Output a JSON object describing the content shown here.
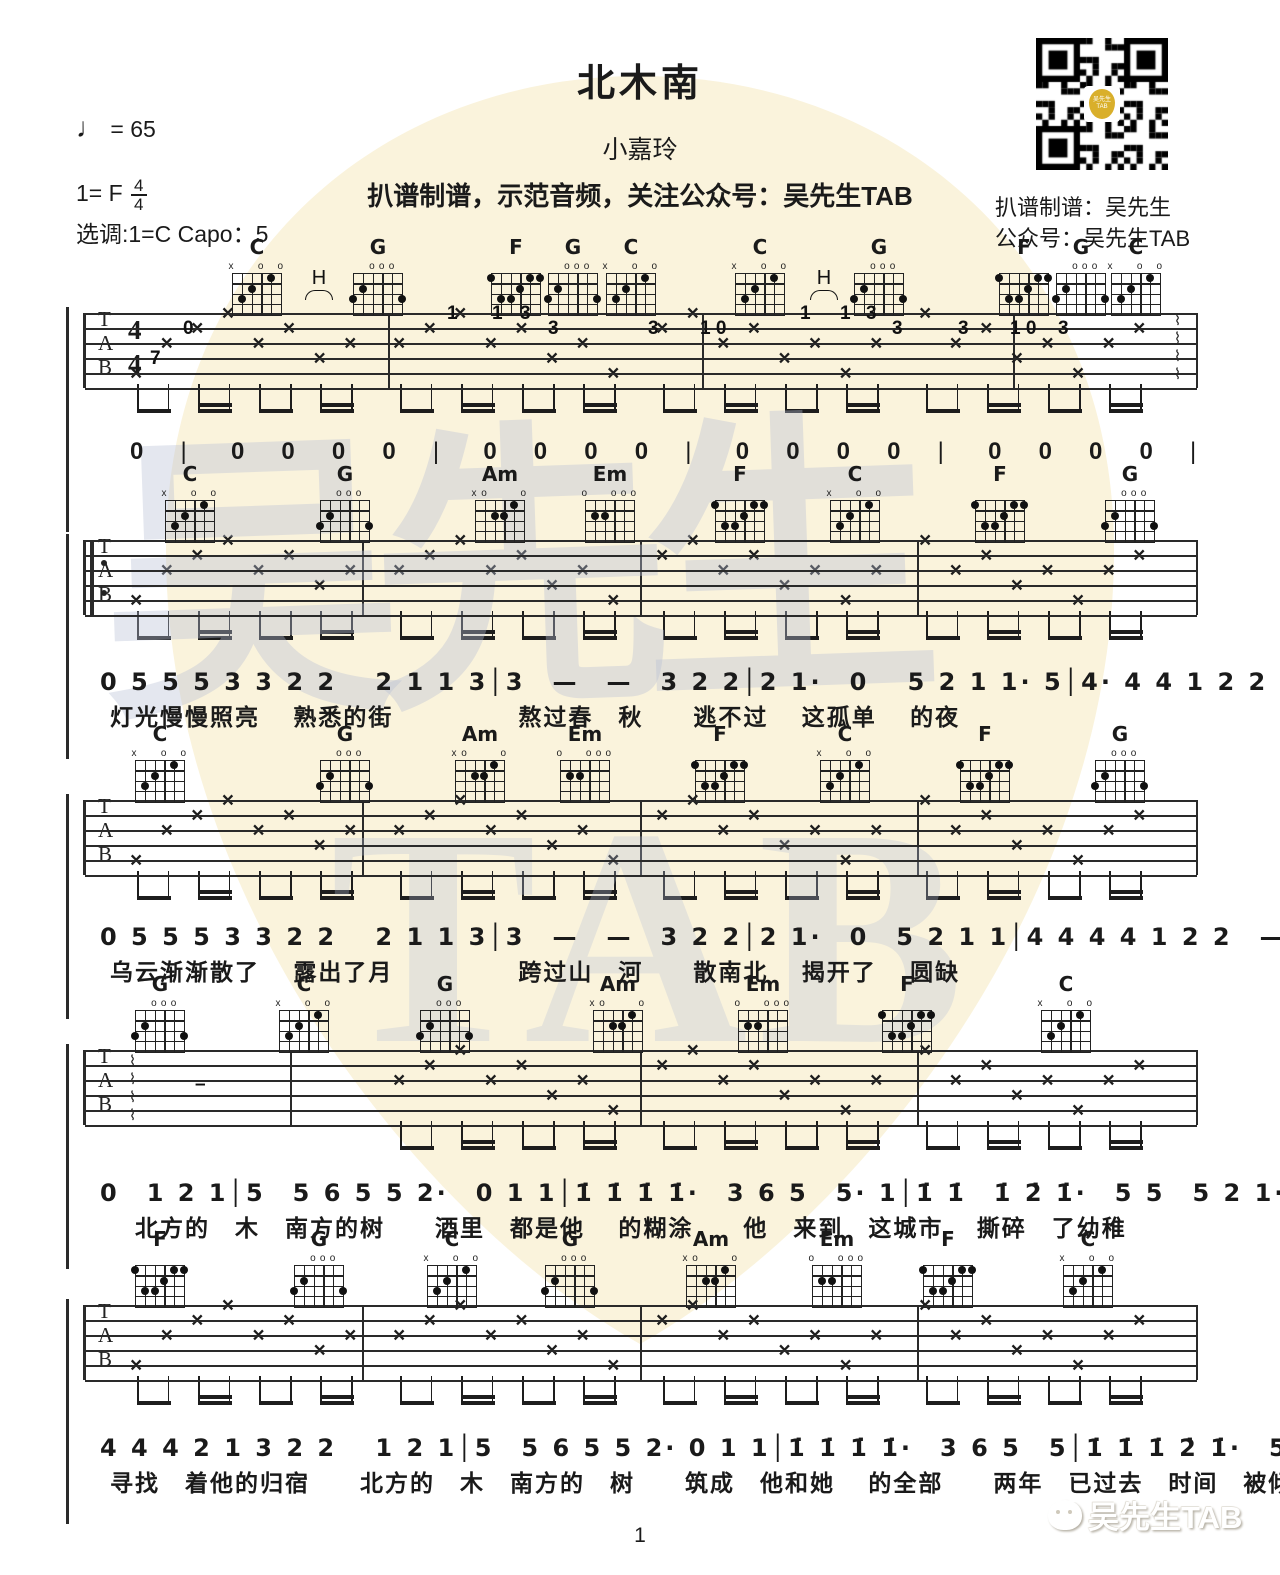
{
  "header": {
    "title": "北木南",
    "artist": "小嘉玲",
    "promo": "扒谱制谱，示范音频，关注公众号：吴先生TAB",
    "tempo_note": "♩",
    "tempo_value": "=  65",
    "key_label": "1= F",
    "time_top": "4",
    "time_bottom": "4",
    "tuning_label": "选调:1=C   Capo：5"
  },
  "qr": {
    "caption_line1": "扒谱制谱：吴先生",
    "caption_line2": "公众号：吴先生TAB",
    "logo_text": "吴先生TAB"
  },
  "watermark": {
    "hanzi": "吴先生",
    "latin": "TAB",
    "pick_color": "#faf3dc",
    "text_color": "#b7c0d6"
  },
  "footer": {
    "page_number": "1",
    "logo_text": "吴先生TAB"
  },
  "chord_shapes": {
    "C": {
      "mute": [
        6
      ],
      "open": [
        3,
        1
      ],
      "dots": [
        [
          5,
          3
        ],
        [
          4,
          2
        ],
        [
          2,
          1
        ]
      ]
    },
    "G": {
      "mute": [],
      "open": [
        4,
        3,
        2
      ],
      "dots": [
        [
          6,
          3
        ],
        [
          5,
          2
        ],
        [
          1,
          3
        ]
      ]
    },
    "F": {
      "mute": [],
      "open": [],
      "dots": [
        [
          6,
          1
        ],
        [
          5,
          3
        ],
        [
          4,
          3
        ],
        [
          3,
          2
        ],
        [
          2,
          1
        ],
        [
          1,
          1
        ]
      ]
    },
    "Am": {
      "mute": [
        6
      ],
      "open": [
        5,
        1
      ],
      "dots": [
        [
          4,
          2
        ],
        [
          3,
          2
        ],
        [
          2,
          1
        ]
      ]
    },
    "Em": {
      "mute": [],
      "open": [
        6,
        3,
        2,
        1
      ],
      "dots": [
        [
          5,
          2
        ],
        [
          4,
          2
        ]
      ]
    }
  },
  "systems": [
    {
      "staff_y": 313,
      "has_time_sig": true,
      "repeat_start": false,
      "end_arrow": true,
      "chords": [
        {
          "name": "C",
          "x": 257
        },
        {
          "name": "G",
          "x": 378
        },
        {
          "name": "F",
          "x": 516
        },
        {
          "name": "G",
          "x": 573
        },
        {
          "name": "C",
          "x": 631
        },
        {
          "name": "C",
          "x": 760
        },
        {
          "name": "G",
          "x": 879
        },
        {
          "name": "F",
          "x": 1024
        },
        {
          "name": "G",
          "x": 1081
        },
        {
          "name": "C",
          "x": 1136
        }
      ],
      "hammer_label": "H",
      "hammers": [
        318,
        823
      ],
      "fret_marks": [
        {
          "t": "0",
          "x": 183,
          "row": 1
        },
        {
          "t": "7",
          "x": 150,
          "row": 3
        },
        {
          "t": "1",
          "x": 447,
          "row": 0
        },
        {
          "t": "1",
          "x": 492,
          "row": 0
        },
        {
          "t": "3",
          "x": 520,
          "row": 0
        },
        {
          "t": "3",
          "x": 548,
          "row": 1
        },
        {
          "t": "3",
          "x": 648,
          "row": 1
        },
        {
          "t": "1 0",
          "x": 700,
          "row": 1
        },
        {
          "t": "1",
          "x": 800,
          "row": 0
        },
        {
          "t": "1",
          "x": 840,
          "row": 0
        },
        {
          "t": "3",
          "x": 866,
          "row": 0
        },
        {
          "t": "3",
          "x": 892,
          "row": 1
        },
        {
          "t": "3",
          "x": 958,
          "row": 1
        },
        {
          "t": "1 0",
          "x": 1010,
          "row": 1
        },
        {
          "t": "3",
          "x": 1058,
          "row": 1
        }
      ],
      "barlines": [
        388,
        702,
        1013
      ]
    },
    {
      "staff_y": 540,
      "has_time_sig": false,
      "repeat_start": true,
      "chords": [
        {
          "name": "C",
          "x": 190
        },
        {
          "name": "G",
          "x": 345
        },
        {
          "name": "Am",
          "x": 500
        },
        {
          "name": "Em",
          "x": 610
        },
        {
          "name": "F",
          "x": 740
        },
        {
          "name": "C",
          "x": 855
        },
        {
          "name": "F",
          "x": 1000
        },
        {
          "name": "G",
          "x": 1130
        }
      ],
      "barlines": [
        362,
        640,
        917
      ]
    },
    {
      "staff_y": 800,
      "has_time_sig": false,
      "repeat_start": false,
      "chords": [
        {
          "name": "C",
          "x": 160
        },
        {
          "name": "G",
          "x": 345
        },
        {
          "name": "Am",
          "x": 480
        },
        {
          "name": "Em",
          "x": 585
        },
        {
          "name": "F",
          "x": 720
        },
        {
          "name": "C",
          "x": 845
        },
        {
          "name": "F",
          "x": 985
        },
        {
          "name": "G",
          "x": 1120
        }
      ],
      "barlines": [
        362,
        640,
        917
      ]
    },
    {
      "staff_y": 1050,
      "has_time_sig": false,
      "repeat_start": false,
      "start_squiggle": true,
      "sustain_dash": true,
      "skip_first_measure": true,
      "chords": [
        {
          "name": "G",
          "x": 160
        },
        {
          "name": "C",
          "x": 304
        },
        {
          "name": "G",
          "x": 445
        },
        {
          "name": "Am",
          "x": 618
        },
        {
          "name": "Em",
          "x": 763
        },
        {
          "name": "F",
          "x": 907
        },
        {
          "name": "C",
          "x": 1066
        }
      ],
      "barlines": [
        290,
        640,
        917
      ]
    },
    {
      "staff_y": 1305,
      "has_time_sig": false,
      "repeat_start": false,
      "chords": [
        {
          "name": "F",
          "x": 160
        },
        {
          "name": "G",
          "x": 319
        },
        {
          "name": "C",
          "x": 452
        },
        {
          "name": "G",
          "x": 570
        },
        {
          "name": "Am",
          "x": 711
        },
        {
          "name": "Em",
          "x": 837
        },
        {
          "name": "F",
          "x": 948
        },
        {
          "name": "C",
          "x": 1088
        }
      ],
      "barlines": [
        362,
        640,
        917
      ]
    }
  ],
  "melody_row": {
    "y": 438,
    "tokens": [
      "0",
      "|",
      "0",
      "0",
      "0",
      "0",
      "|",
      "0",
      "0",
      "0",
      "0",
      "|",
      "0",
      "0",
      "0",
      "0",
      "|",
      "0",
      "0",
      "0",
      "0",
      "|"
    ]
  },
  "vocal_lines": [
    {
      "numbers_y": 662,
      "lyrics_y": 698,
      "numbers": "0 5 5 5 3 3 2 2　 2 1 1 3│3　—　—　3 2 2│2 1·　0　 5 2 1 1· 5│4· 4 4 1 2 2　—",
      "lyrics": "灯光慢慢照亮　 熟悉的街　　　　　熬过春　秋　　逃不过　 这孤单　 的夜",
      "annotations": "slur arcs over 1 3, 2 2, 1·, 1·5, 4·4, 2 2"
    },
    {
      "numbers_y": 917,
      "lyrics_y": 953,
      "numbers": "0 5 5 5 3 3 2 2　 2 1 1 3│3　—　—　3 2 2│2 1·　0　5 2 1 1│4 4 4 4 1 2 2　—",
      "lyrics": "乌云渐渐散了　 露出了月　　　　　跨过山　河　　散南北　 揭开了　 圆缺",
      "annotations": "slur arcs over 2 2, 1 3, 2 1·, 1 1, 4 4, 2 2"
    },
    {
      "numbers_y": 1173,
      "lyrics_y": 1209,
      "numbers": "0　1 2 1│5　5 6 5 5 2·　0 1 1│1̇ 1̇ 1̇ 1̇·　3 6 5　5· 1│1̇ 1̇　1̇ 2̇ 1̇·　5 5　5 2 1·",
      "lyrics": "　北方的　木　南方的树　　酒里　都是他　 的糊涂　　他　来到　这城市　 撕碎　了幼稚",
      "annotations": "triplet 3 over 1 2 1; slur arcs over 5 2·, 1̇ 1̇·, 5· 1, 2̇ 1̇·, 2 1·"
    },
    {
      "numbers_y": 1428,
      "lyrics_y": 1464,
      "numbers": "4 4 4 2 1 3 2 2　 1 2 1│5　5 6 5 5 2· 0 1 1│1̇ 1̇ 1̇ 1̇·　3 6 5　5│1̇ 1̇ 1̇ 2̇ 1̇·　5 5 5 2 1·",
      "lyrics": "寻找　着他的归宿　　北方的　木　南方的　树　　筑成　他和她　 的全部　　两年　已过去　时间　被倾诉",
      "annotations": "slur arc over 2 2; triplet 3 over 1 2 1; slur arcs over 5 2·, 1̇ 1̇·, 2̇ 1̇·, 2 1·"
    }
  ]
}
